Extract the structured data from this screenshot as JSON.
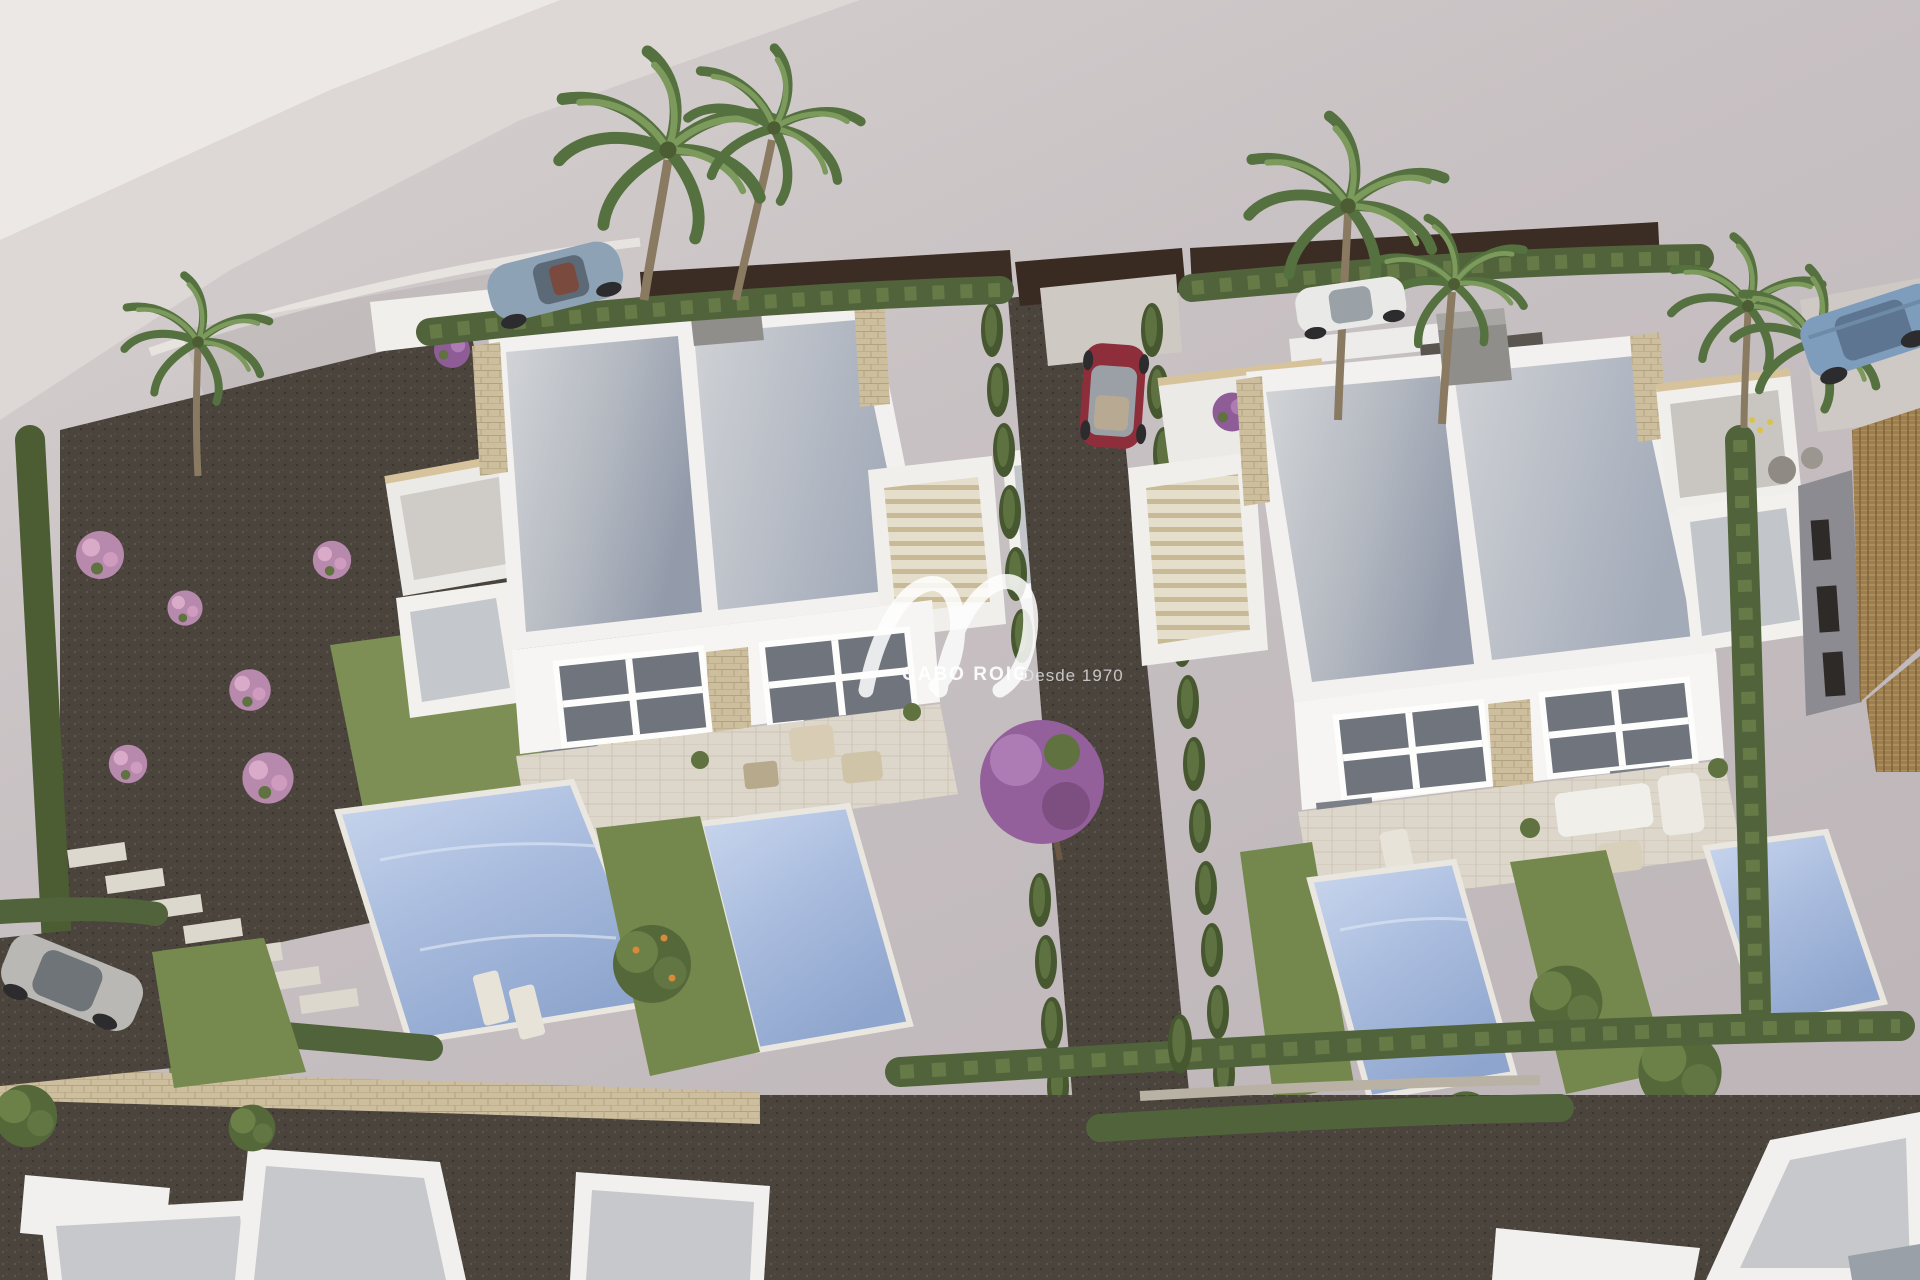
{
  "image": {
    "kind": "aerial 3D architectural render",
    "subject": "Residential development of two modern white semi-detached villas with private pools, landscaped gardens, gravel paths, cypress hedges, palm trees and parked cars, next to an existing tiled-roof house"
  },
  "watermark": {
    "brand": "CABO ROIG",
    "tagline": "Desde 1970",
    "logo": "wave-signature"
  },
  "palette": {
    "ground": "#c7c0c2",
    "ground_light": "#eae6e3",
    "gravel": "#4a443d",
    "grass": "#7d8f55",
    "hedge_green": "#51633a",
    "roof_gray": "#b9bdc4",
    "wall_white": "#f4f3f1",
    "stone_beige": "#d3c29c",
    "pool_blue": "#a9bcde",
    "terrace": "#dcd6cb",
    "terracotta": "#9d7e50",
    "bloom_pink": "#c493b7",
    "bloom_purple": "#9c64a0",
    "car_red": "#8d2e3a",
    "car_sport_blue": "#8ea2b6",
    "car_suv_blue": "#7e9cbb",
    "car_white": "#e9e9e7",
    "car_silver": "#b9b8b4"
  }
}
